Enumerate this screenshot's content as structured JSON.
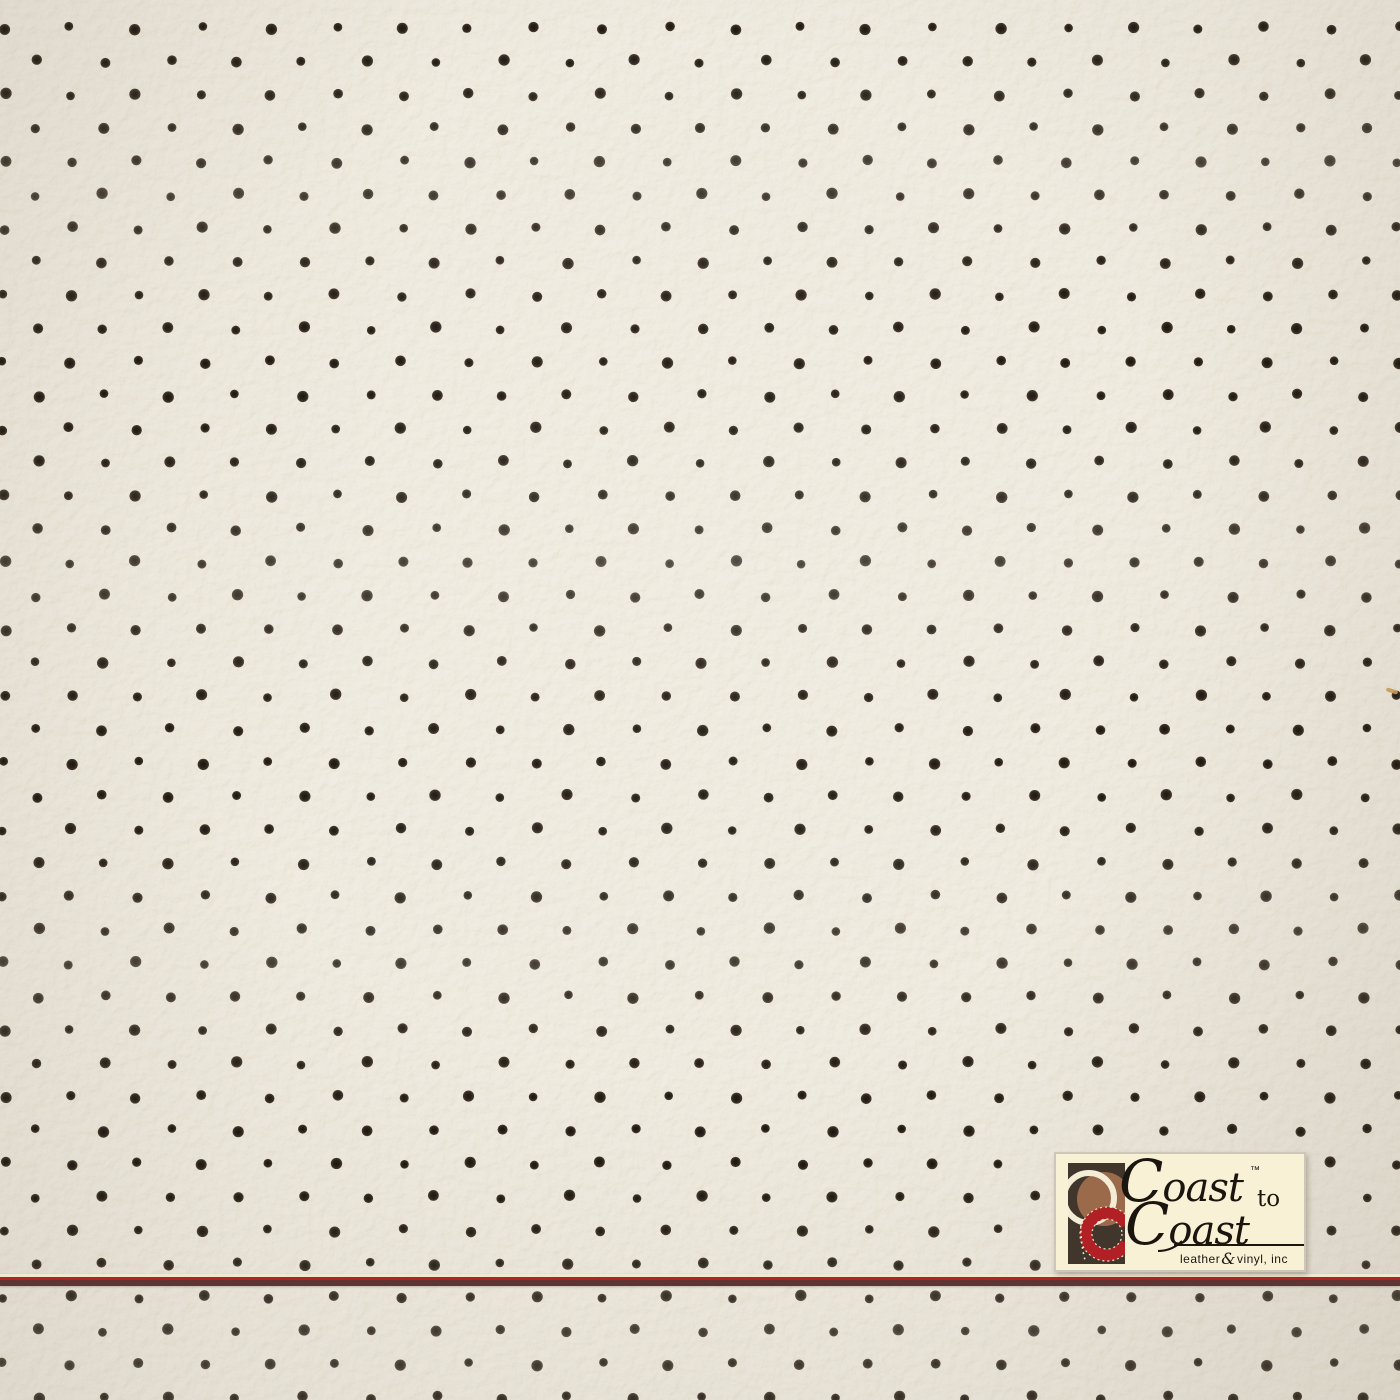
{
  "meta": {
    "subject": "perforated cream leather-vinyl upholstery swatch photo"
  },
  "material": {
    "background_color": "#e3dbc7",
    "perforation": {
      "dot_center_color": "#171310",
      "dot_color": "#29221a",
      "dot_rim_color": "#473c2c",
      "dot_radius_px": 5,
      "row_start_y_px": 28,
      "row_step_px": 33.4,
      "col_step_px": 66.4,
      "even_row_x_phase_px": 4,
      "odd_row_x_phase_px": 37.2,
      "jitter_px": 2.2
    },
    "surface_fleck": {
      "x_px": 1386,
      "y_px": 689,
      "width_px": 12,
      "height_px": 4,
      "color": "#c79a55",
      "angle_deg": 18
    }
  },
  "accent_line": {
    "y_px": 1274,
    "segments": [
      {
        "name": "accent-line-cream",
        "color": "#efe8d3",
        "height_px": 3
      },
      {
        "name": "accent-line-red",
        "color": "#b5231d",
        "height_px": 3
      },
      {
        "name": "accent-line-maroon",
        "color": "#5d3534",
        "height_px": 6
      }
    ]
  },
  "logo": {
    "box_bg": "#f8f1d5",
    "border_color": "#ccc7b6",
    "text_color": "#1b1510",
    "brand_line1": {
      "initial": "C",
      "rest": "oast"
    },
    "trademark": "™",
    "connector": "to",
    "brand_line2": {
      "initial": "C",
      "rest": "oast"
    },
    "tagline": {
      "left": "leather",
      "amp": "&",
      "right": "vinyl, inc"
    },
    "mark": {
      "square": "#40362c",
      "circle_brown": "#9b6a4a",
      "ring_cream": "#f4edd5",
      "ring_red": "#b02024",
      "stitch": "#efe6cd"
    }
  }
}
